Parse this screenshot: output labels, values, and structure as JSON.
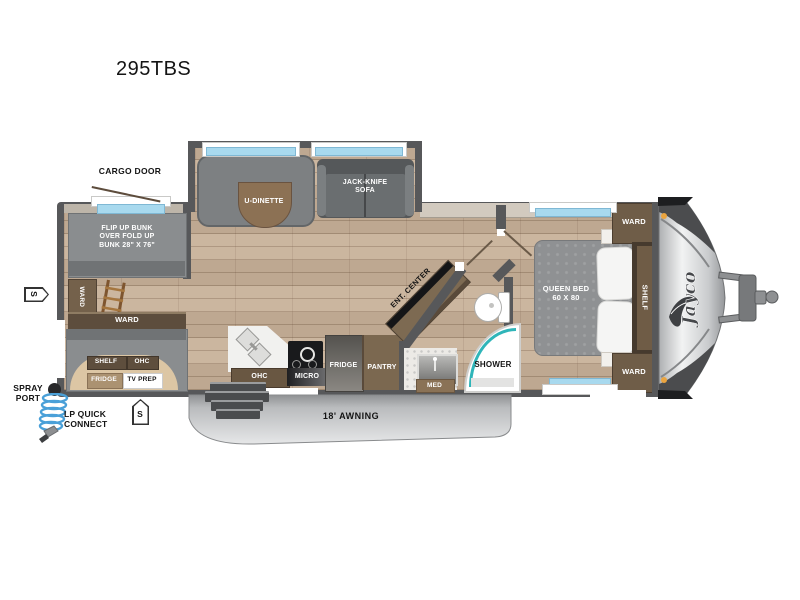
{
  "title": "295TBS",
  "brand": "Jayco",
  "exterior": {
    "cargo_door": "CARGO DOOR",
    "spray_port": "SPRAY\nPORT",
    "lp_quick_connect": "LP QUICK\nCONNECT",
    "awning": "18' AWNING",
    "stake_left": "S",
    "stake_bottom": "S"
  },
  "bunk_room": {
    "flip_bunk": "FLIP UP BUNK\nOVER FOLD UP\nBUNK 28\" X 76\"",
    "ward_side": "WARD",
    "ward_lower": "WARD",
    "shelf": "SHELF",
    "ohc": "OHC",
    "fridge": "FRIDGE",
    "tv_prep": "TV PREP"
  },
  "living": {
    "u_dinette": "U-DINETTE",
    "jack_knife_sofa": "JACK-KNIFE\nSOFA",
    "ent_center": "ENT. CENTER"
  },
  "kitchen": {
    "ohc": "OHC",
    "micro": "MICRO",
    "fridge": "FRIDGE",
    "pantry": "PANTRY"
  },
  "bath": {
    "shower": "SHOWER",
    "med": "MED"
  },
  "bedroom": {
    "queen_bed": "QUEEN BED\n60 X 80",
    "ward_top": "WARD",
    "shelf": "SHELF",
    "ward_bottom": "WARD"
  }
}
